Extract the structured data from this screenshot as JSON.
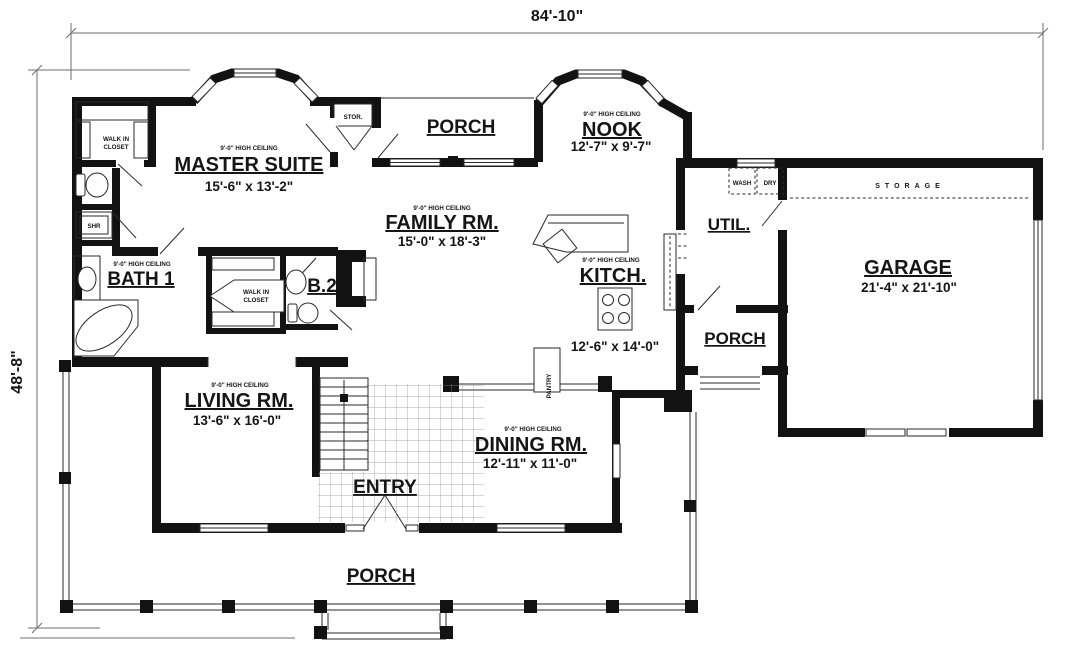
{
  "plan": {
    "overall_width": "84'-10\"",
    "overall_depth": "48'-8\"",
    "ceiling_note": "9'-0\" HIGH CEILING",
    "rooms": {
      "master_suite": {
        "name": "MASTER SUITE",
        "size": "15'-6\" x 13'-2\""
      },
      "family_room": {
        "name": "FAMILY RM.",
        "size": "15'-0\" x 18'-3\""
      },
      "nook": {
        "name": "NOOK",
        "size": "12'-7\" x 9'-7\""
      },
      "kitchen": {
        "name": "KITCH.",
        "size": "12'-6\" x 14'-0\""
      },
      "living_room": {
        "name": "LIVING RM.",
        "size": "13'-6\" x 16'-0\""
      },
      "dining_room": {
        "name": "DINING RM.",
        "size": "12'-11\" x 11'-0\""
      },
      "garage": {
        "name": "GARAGE",
        "size": "21'-4\" x 21'-10\""
      },
      "bath_1": {
        "name": "BATH 1"
      },
      "bath_2": {
        "name": "B.2"
      },
      "utility": {
        "name": "UTIL."
      },
      "entry": {
        "name": "ENTRY"
      },
      "porch": {
        "name": "PORCH"
      },
      "storage": {
        "name": "STORAGE"
      },
      "stor_closet": {
        "name": "STOR."
      },
      "walk_in_closet": {
        "line1": "WALK IN",
        "line2": "CLOSET"
      },
      "shower": {
        "name": "SHR"
      },
      "pantry": {
        "name": "PANTRY"
      },
      "wash": {
        "name": "WASH"
      },
      "dry": {
        "name": "DRY"
      }
    }
  }
}
